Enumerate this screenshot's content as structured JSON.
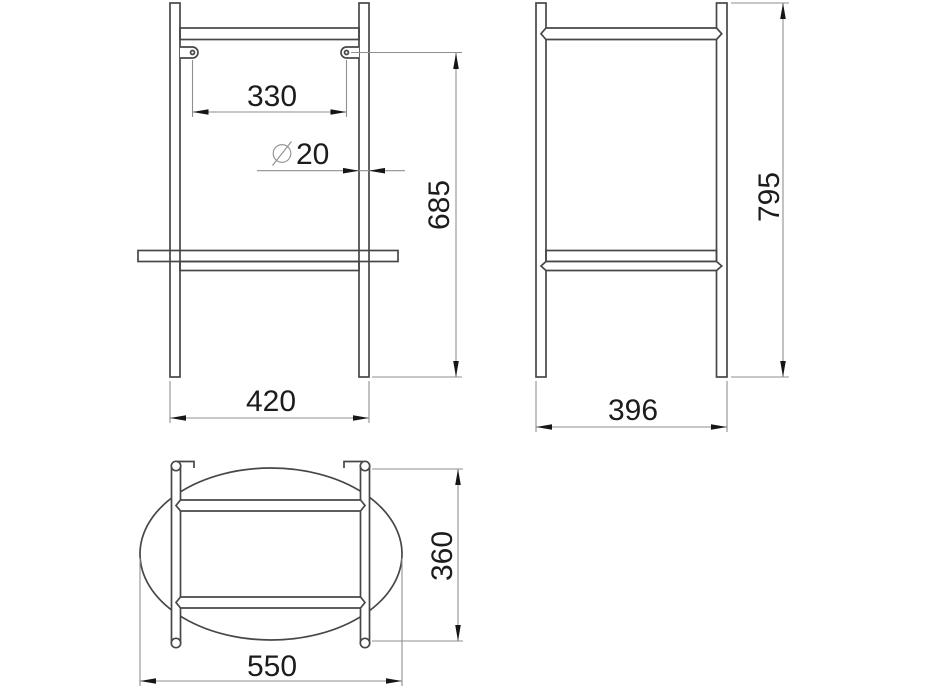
{
  "drawing": {
    "type": "technical-drawing",
    "subject": "tube frame stand with oval shelf, three orthographic views",
    "colors": {
      "background": "#ffffff",
      "main_line": "#474747",
      "dimension_line": "#8f8f8f",
      "text": "#1c1c1c"
    },
    "views": {
      "front": {
        "label": "front-view",
        "dims": [
          {
            "id": "tab-hole-spacing",
            "value": "330"
          },
          {
            "id": "tube-diameter",
            "symbol": "⌀",
            "value": "20"
          },
          {
            "id": "tab-hole-height",
            "value": "685"
          },
          {
            "id": "overall-width",
            "value": "420"
          }
        ]
      },
      "side": {
        "label": "side-view",
        "dims": [
          {
            "id": "overall-height",
            "value": "795"
          },
          {
            "id": "overall-depth",
            "value": "396"
          }
        ]
      },
      "top": {
        "label": "top-view",
        "dims": [
          {
            "id": "shelf-width",
            "value": "550"
          },
          {
            "id": "shelf-depth",
            "value": "360"
          }
        ]
      }
    }
  }
}
